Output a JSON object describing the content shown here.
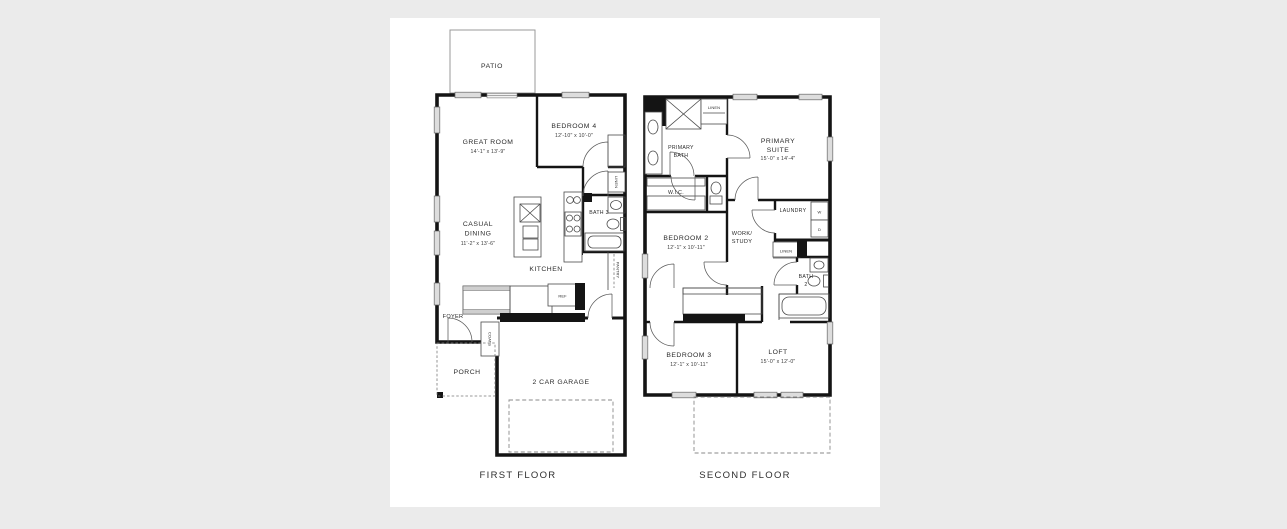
{
  "scene": {
    "background": "#ebebeb",
    "sheet": "#ffffff",
    "wall_color": "#141414"
  },
  "first_floor": {
    "caption": "FIRST FLOOR",
    "patio": {
      "label": "PATIO"
    },
    "great_room": {
      "label": "GREAT ROOM",
      "dims": "14'-1\" x 13'-9\""
    },
    "bedroom_4": {
      "label": "BEDROOM 4",
      "dims": "12'-10\" x 10'-0\""
    },
    "casual_dining": {
      "line1": "CASUAL",
      "line2": "DINING",
      "dims": "11'-2\" x 13'-6\""
    },
    "kitchen": {
      "label": "KITCHEN"
    },
    "bath_3": {
      "label": "BATH 3"
    },
    "linen": {
      "label": "LINEN"
    },
    "pantry": {
      "label": "PANTRY"
    },
    "ref": {
      "label": "REF"
    },
    "coats": {
      "label": "COATS"
    },
    "foyer": {
      "label": "FOYER"
    },
    "porch": {
      "label": "PORCH"
    },
    "garage": {
      "label": "2 CAR GARAGE"
    }
  },
  "second_floor": {
    "caption": "SECOND FLOOR",
    "primary_bath": {
      "line1": "PRIMARY",
      "line2": "BATH"
    },
    "linen_upper": {
      "label": "LINEN"
    },
    "primary_suite": {
      "line1": "PRIMARY",
      "line2": "SUITE",
      "dims": "15'-0\" x 14'-4\""
    },
    "wic": {
      "label": "W.I.C."
    },
    "laundry": {
      "label": "LAUNDRY",
      "washer": "W",
      "dryer": "D"
    },
    "bedroom_2": {
      "label": "BEDROOM 2",
      "dims": "12'-1\" x 10'-11\""
    },
    "work_study": {
      "line1": "WORK/",
      "line2": "STUDY"
    },
    "linen_mid": {
      "label": "LINEN"
    },
    "bath_2": {
      "line1": "BATH",
      "line2": "2"
    },
    "bedroom_3": {
      "label": "BEDROOM 3",
      "dims": "12'-1\" x 10'-11\""
    },
    "loft": {
      "label": "LOFT",
      "dims": "15'-0\" x 12'-0\""
    }
  }
}
